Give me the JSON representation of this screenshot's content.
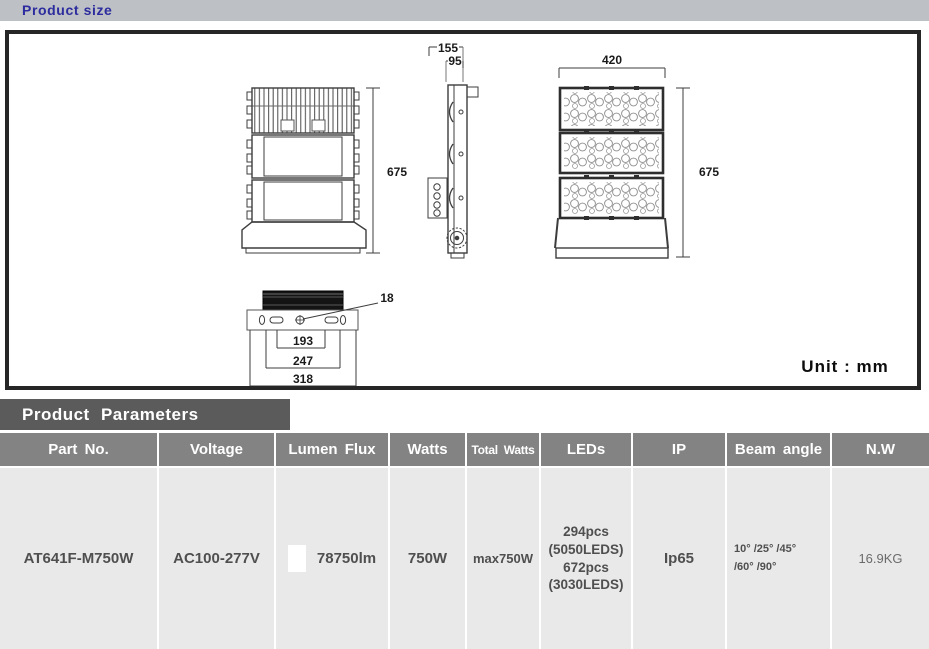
{
  "header": {
    "title": "Product size"
  },
  "drawing": {
    "unit_label": "Unit : mm",
    "dim_side_overall": "155",
    "dim_side_body": "95",
    "dim_front_width": "420",
    "dim_back_height": "675",
    "dim_front_height": "675",
    "dim_hole": "18",
    "dim_mount_inner": "193",
    "dim_mount_mid": "247",
    "dim_mount_outer": "318"
  },
  "parameters": {
    "section_title": "Product Parameters",
    "columns": {
      "part_no": "Part No.",
      "voltage": "Voltage",
      "lumen_flux": "Lumen Flux",
      "watts": "Watts",
      "total_watts": "Total Watts",
      "leds": "LEDs",
      "ip": "IP",
      "beam_angle": "Beam angle",
      "nw": "N.W"
    },
    "row": {
      "part_no": "AT641F-M750W",
      "voltage": "AC100-277V",
      "lumen_flux": "78750lm",
      "watts": "750W",
      "total_watts": "max750W",
      "leds": [
        "294pcs",
        "(5050LEDS)",
        "672pcs",
        "(3030LEDS)"
      ],
      "ip": "Ip65",
      "beam_angle": [
        "10° /25° /45°",
        "/60° /90°"
      ],
      "nw": "16.9KG"
    }
  },
  "colors": {
    "accent_blue": "#2c2c9e",
    "topbar_gray": "#bdc0c5",
    "section_bar": "#5b5b5b",
    "table_header": "#838383",
    "table_row": "#e9e9e9"
  }
}
